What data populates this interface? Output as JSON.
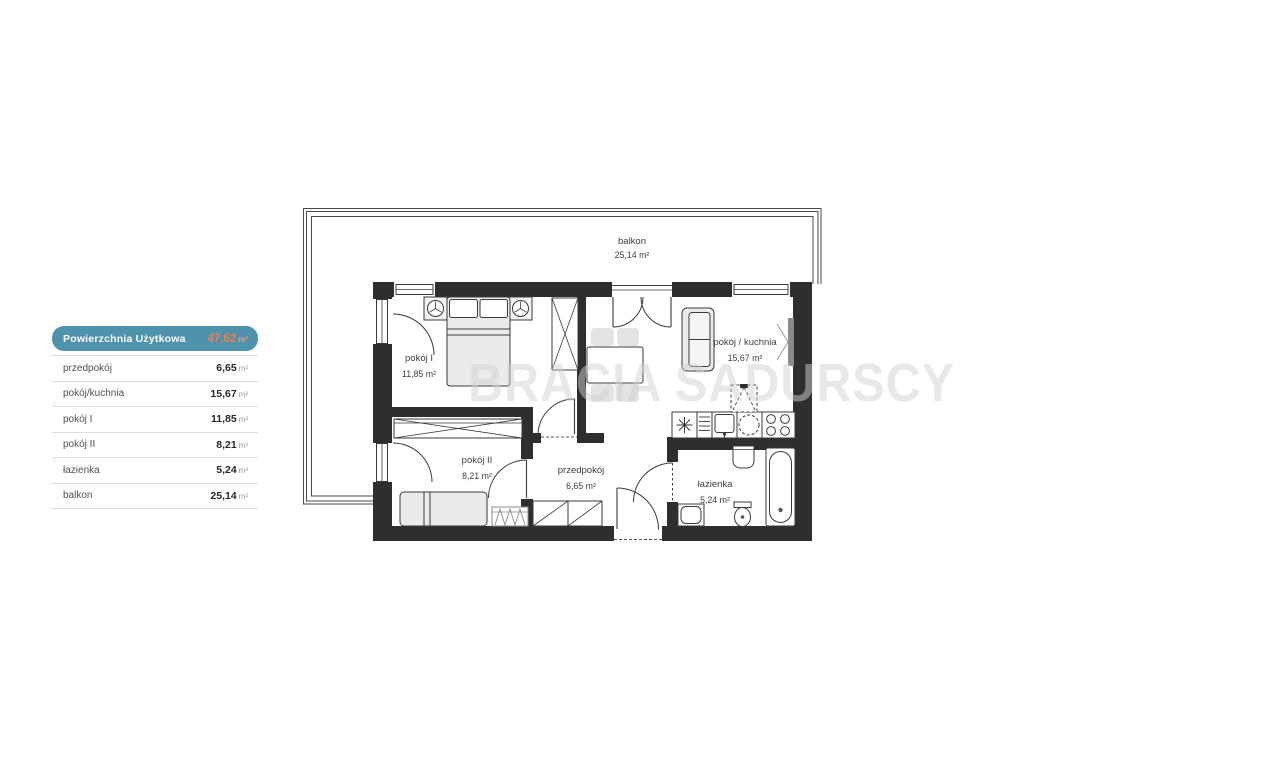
{
  "legend": {
    "header": {
      "label": "Powierzchnia Użytkowa",
      "value": "47,62",
      "unit": "m²"
    },
    "rows": [
      {
        "label": "przedpokój",
        "value": "6,65",
        "unit": "m²"
      },
      {
        "label": "pokój/kuchnia",
        "value": "15,67",
        "unit": "m²"
      },
      {
        "label": "pokój I",
        "value": "11,85",
        "unit": "m²"
      },
      {
        "label": "pokój II",
        "value": "8,21",
        "unit": "m²"
      },
      {
        "label": "łazienka",
        "value": "5,24",
        "unit": "m²"
      },
      {
        "label": "balkon",
        "value": "25,14",
        "unit": "m²"
      }
    ]
  },
  "plan": {
    "watermark": "BRACIA SADURSCY",
    "rooms": [
      {
        "name": "balkon",
        "area": "25,14 m²"
      },
      {
        "name": "pokój I",
        "area": "11,85 m²"
      },
      {
        "name": "pokój / kuchnia",
        "area": "15,67 m²"
      },
      {
        "name": "pokój II",
        "area": "8,21 m²"
      },
      {
        "name": "przedpokój",
        "area": "6,65 m²"
      },
      {
        "name": "łazienka",
        "area": "5,24 m²"
      }
    ]
  },
  "colors": {
    "legend_header_bg": "#4e92ac",
    "legend_accent_orange": "#ee7c55",
    "wall": "#2e2e2e",
    "furniture_fill": "#ebebeb",
    "watermark_gray": "#d2d2d2",
    "railing": "#4a4a4a"
  }
}
